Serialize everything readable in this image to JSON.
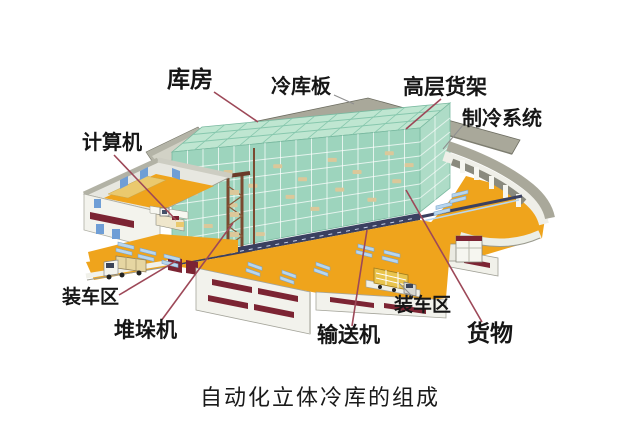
{
  "caption": "自动化立体冷库的组成",
  "labels": [
    {
      "id": "storeroom",
      "text": "库房"
    },
    {
      "id": "cold-panel",
      "text": "冷库板"
    },
    {
      "id": "high-rack",
      "text": "高层货架"
    },
    {
      "id": "refrigeration",
      "text": "制冷系统"
    },
    {
      "id": "computer",
      "text": "计算机"
    },
    {
      "id": "loading-left",
      "text": "装车区"
    },
    {
      "id": "stacker-crane",
      "text": "堆垛机"
    },
    {
      "id": "conveyor",
      "text": "输送机"
    },
    {
      "id": "loading-right",
      "text": "装车区"
    },
    {
      "id": "goods",
      "text": "货物"
    }
  ],
  "colors": {
    "rack_green": "#9dd4bd",
    "rack_green_top": "#bfe6d1",
    "floor_orange": "#efa41c",
    "roof_gray": "#a9a89a",
    "wall_white": "#f2f2ec",
    "vent_maroon": "#7c2433",
    "leader_red": "#9d4858",
    "leader_gray": "#8f8f8f",
    "conveyor_blue": "#b8d6ee",
    "annex_floor_tan": "#eac96e",
    "label_text": "#161616"
  }
}
